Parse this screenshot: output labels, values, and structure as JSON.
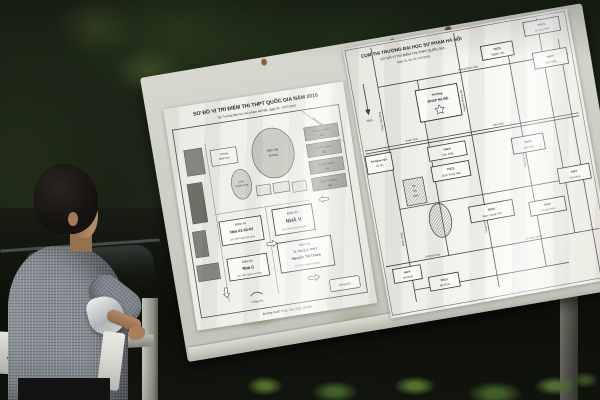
{
  "scene": {
    "license_plate_fragment": "1"
  },
  "poster_left": {
    "title": "SƠ ĐỒ VỊ TRÍ ĐIỂM THI THPT QUỐC GIA NĂM 2016",
    "subtitle": "Tại Trường Đại học Sư phạm Hà Nội, ngày 01 - 02/7/2016",
    "dorm_area": "Khu ký túc xá",
    "hall": {
      "l1": "Nhà Hội",
      "l2": "trường"
    },
    "pagoda": {
      "l1": "Chùa",
      "l2": "Thánh Chúa"
    },
    "kindergarten": {
      "l1": "Trường",
      "l2": "Mầm non"
    },
    "lab_blocks": [
      {
        "l1": "Khu thí nghiệm",
        "l2": "A1"
      },
      {
        "l1": "Khu thí nghiệm",
        "l2": "A2"
      },
      {
        "l1": "Khu thí nghiệm",
        "l2": "A3"
      },
      {
        "l1": "Khu thí nghiệm",
        "l2": "A4"
      }
    ],
    "sites": [
      {
        "l1": "Điểm thi",
        "l2": "Nhà 01-02-03",
        "l3": "(Thi THPT Quốc Gia 2016)"
      },
      {
        "l1": "Điểm thi",
        "l2": "NHÀ V",
        "l3": "(Thi THPT Quốc Gia 2016)"
      },
      {
        "l1": "Điểm thi",
        "l2": "Nhà C",
        "l3": "(Thi THPT Quốc Gia 2016)"
      },
      {
        "l1": "Điểm thi",
        "l2": "Tr. THCS & THPT",
        "l3": "Nguyễn Tất Thành",
        "l4": "(Thi THPT Quốc Gia 2016)"
      }
    ],
    "gate1": "Cổng số 1",
    "gate2": "Cổng số 2",
    "street_bottom": "Đường Xuân Thủy, Cầu Giấy, Hà Nội"
  },
  "poster_right": {
    "title1": "CỤM THI TRƯỜNG ĐẠI HỌC SƯ PHẠM HÀ NỘI",
    "title2": "SƠ ĐỒ VỊ TRÍ ĐIỂM THI THPT QUỐC GIA",
    "title3": "Ngày 01, 02, 03, 04/7/2016",
    "compass_south": "Nam",
    "university": {
      "l1": "Trường",
      "l2": "ĐHSP Hà Nội"
    },
    "other_university": {
      "l1": "ĐH Ngoại ngữ",
      "l2": "Hà Nội"
    },
    "stadium": {
      "l1": "Sân",
      "l2": "vận",
      "l3": "động"
    },
    "schools": [
      {
        "l1": "THCS",
        "l2": "Nghĩa Tân"
      },
      {
        "l1": "THCS",
        "l2": "Lê Quý Đôn"
      },
      {
        "l1": "THPT",
        "l2": "Cầu Giấy"
      },
      {
        "l1": "THCS",
        "l2": "Cầu Giấy"
      },
      {
        "l1": "THCS",
        "l2": "Dịch Vọng Hậu"
      },
      {
        "l1": "THCS",
        "l2": "Yên Hòa"
      },
      {
        "l1": "THPT",
        "l2": "Yên Hòa"
      },
      {
        "l1": "THCS",
        "l2": "Trung Hòa"
      },
      {
        "l1": "THCS",
        "l2": "Nam Trung Yên"
      },
      {
        "l1": "THPT",
        "l2": "Mỹ Đình"
      },
      {
        "l1": "THCS",
        "l2": "Mỹ Đình"
      }
    ],
    "streets": {
      "hoang_quoc_viet": "Hoàng Quốc Việt",
      "pham_van_dong": "Phạm Văn Đồng",
      "xuan_thuy": "Xuân Thủy",
      "cau_giay": "Cầu Giấy",
      "nguyen_phong_sac": "Nguyễn Phong Sắc",
      "tran_duy_hung": "Trần Duy Hưng",
      "pham_hung": "Phạm Hùng",
      "trung_kinh": "Trung Kính",
      "le_van_luong": "Lê Văn Lương",
      "duong_lang": "Đường Láng"
    }
  }
}
